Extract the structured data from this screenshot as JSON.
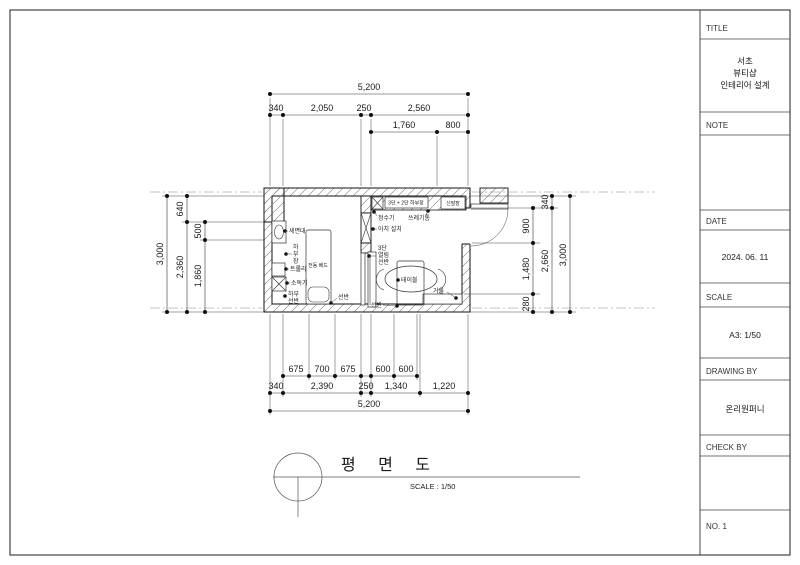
{
  "title_block": {
    "title_label": "TITLE",
    "project_line1": "서초",
    "project_line2": "뷰티샵",
    "project_line3": "인테리어 설계",
    "note_label": "NOTE",
    "date_label": "DATE",
    "date_value": "2024. 06. 11",
    "scale_label": "SCALE",
    "scale_value": "A3: 1/50",
    "drawing_by_label": "DRAWING BY",
    "drawing_by_value": "온리원퍼니",
    "check_by_label": "CHECK BY",
    "sheet_no": "NO. 1"
  },
  "drawing_title": {
    "text": "평  면  도",
    "scale_note": "SCALE : 1/50"
  },
  "dims": {
    "top": {
      "total": "5,200",
      "row2": [
        "340",
        "2,050",
        "250",
        "2,560"
      ],
      "row3": [
        "1,760",
        "800"
      ]
    },
    "bottom": {
      "row1": [
        "675",
        "700",
        "675",
        "600",
        "600"
      ],
      "row2": [
        "340",
        "2,390",
        "250",
        "1,340",
        "1,220"
      ],
      "total": "5,200"
    },
    "left": {
      "total": "3,000",
      "mid": [
        "640",
        "2,360"
      ],
      "inner": [
        "500",
        "1,860"
      ]
    },
    "right": {
      "inner": [
        "900",
        "1,480",
        "280"
      ],
      "mid": [
        "340",
        "2,660"
      ],
      "total": "3,000"
    }
  },
  "labels": {
    "washbasin": "세면대",
    "lower_cabinet": [
      "하",
      "부",
      "장"
    ],
    "trolley": "트롤리",
    "sterilizer": "소독기",
    "lower_shelf": [
      "하부",
      "선반"
    ],
    "electric_bed": "전동 베드",
    "shelf_left": "선반",
    "top_cabinet": "3단 + 2단 하부장",
    "water_purifier": "정수기",
    "trash_bin": "쓰레기통",
    "shoe_cabinet": "신발장",
    "arch": "아치 설치",
    "tier_shelf": [
      "3단",
      "열림",
      "선반"
    ],
    "table": "테이블",
    "mirror": "거울",
    "shelf_right": "선반"
  }
}
